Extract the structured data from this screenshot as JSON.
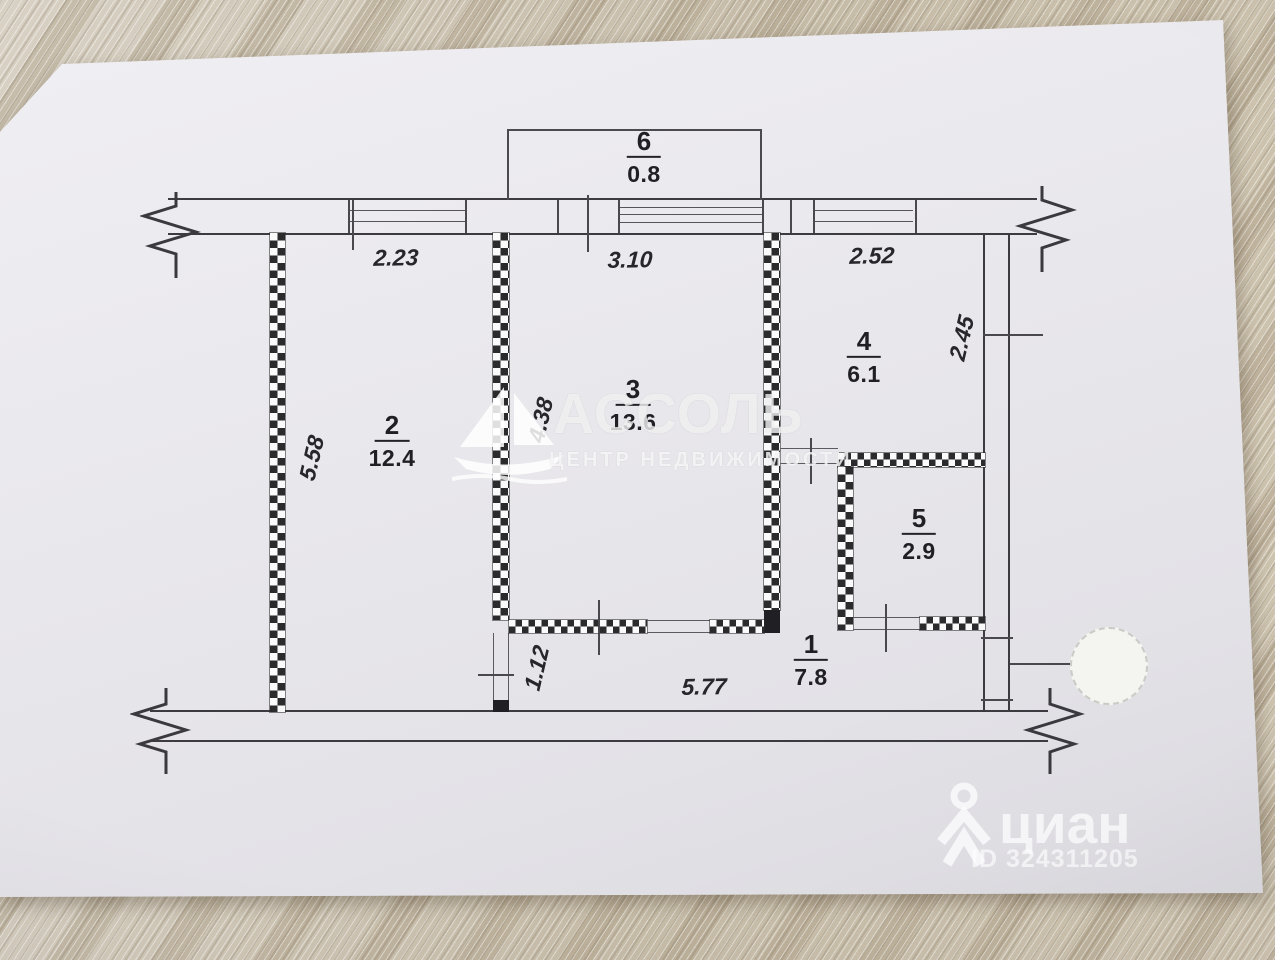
{
  "plan": {
    "rooms": [
      {
        "number": "1",
        "area": "7.8"
      },
      {
        "number": "2",
        "area": "12.4"
      },
      {
        "number": "3",
        "area": "13.6"
      },
      {
        "number": "4",
        "area": "6.1"
      },
      {
        "number": "5",
        "area": "2.9"
      },
      {
        "number": "6",
        "area": "0.8"
      }
    ],
    "dimensions": {
      "room2_width": "2.23",
      "room3_width": "3.10",
      "room4_width": "2.52",
      "right_side": "2.45",
      "room2_depth": "5.58",
      "room3_depth": "4.38",
      "hall_width": "5.77",
      "hall_depth": "1.12"
    }
  },
  "watermarks": {
    "agency_name": "АССОЛЬ",
    "agency_tagline": "ЦЕНТР НЕДВИЖИМОСТИ",
    "agency_logo_icon": "sailboat-icon",
    "portal_name": "циан",
    "portal_id": "ID 324311205",
    "portal_logo_icon": "map-pin-person-icon"
  }
}
